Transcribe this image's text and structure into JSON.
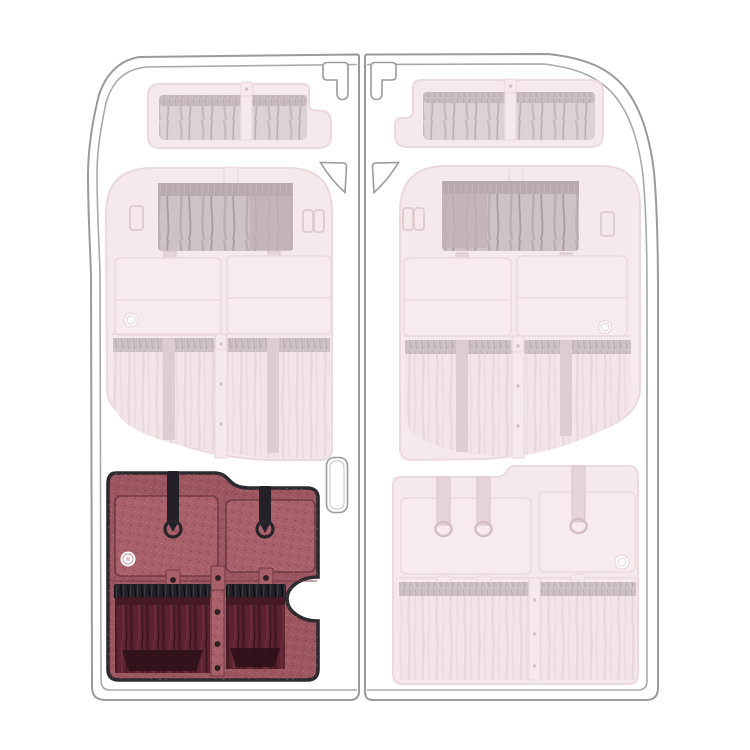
{
  "product": {
    "title": "Van rear door organizer — module location diagram",
    "view": "rear-door-interior",
    "doors": [
      "left-rear-door",
      "right-rear-door"
    ],
    "modules": [
      {
        "id": "upper-pocket-panel-left",
        "door": "left",
        "position": "top",
        "state": "ghosted"
      },
      {
        "id": "upper-pocket-panel-right",
        "door": "right",
        "position": "top",
        "state": "ghosted"
      },
      {
        "id": "mid-organizer-panel-left",
        "door": "left",
        "position": "middle",
        "state": "ghosted"
      },
      {
        "id": "mid-organizer-panel-right",
        "door": "right",
        "position": "middle",
        "state": "ghosted"
      },
      {
        "id": "lower-organizer-panel-left",
        "door": "left",
        "position": "bottom",
        "state": "highlighted"
      },
      {
        "id": "lower-organizer-panel-right",
        "door": "right",
        "position": "bottom",
        "state": "ghosted"
      }
    ],
    "highlighted_module": "lower-organizer-panel-left"
  },
  "colors": {
    "background": "#ffffff",
    "door_line": "#9a9a9a",
    "door_line_inner": "#a9a9a9",
    "ghost_fill": "#f6e9eb",
    "ghost_edge": "#ebd9dc",
    "ghost_mesh": "#d9cdd1",
    "ghost_mesh_dark": "#c3b5b9",
    "ghost_interior": "#f3e5e7",
    "highlight_base": "#9c5660",
    "highlight_light": "#a86069",
    "highlight_seam": "#713844",
    "interior_dark": "#5d2331",
    "interior_shadow": "#2f1119",
    "strap_black": "#232127",
    "border_black": "#2b2930",
    "badge_white": "#ffffff",
    "badge_ring": "#cf8b93"
  }
}
